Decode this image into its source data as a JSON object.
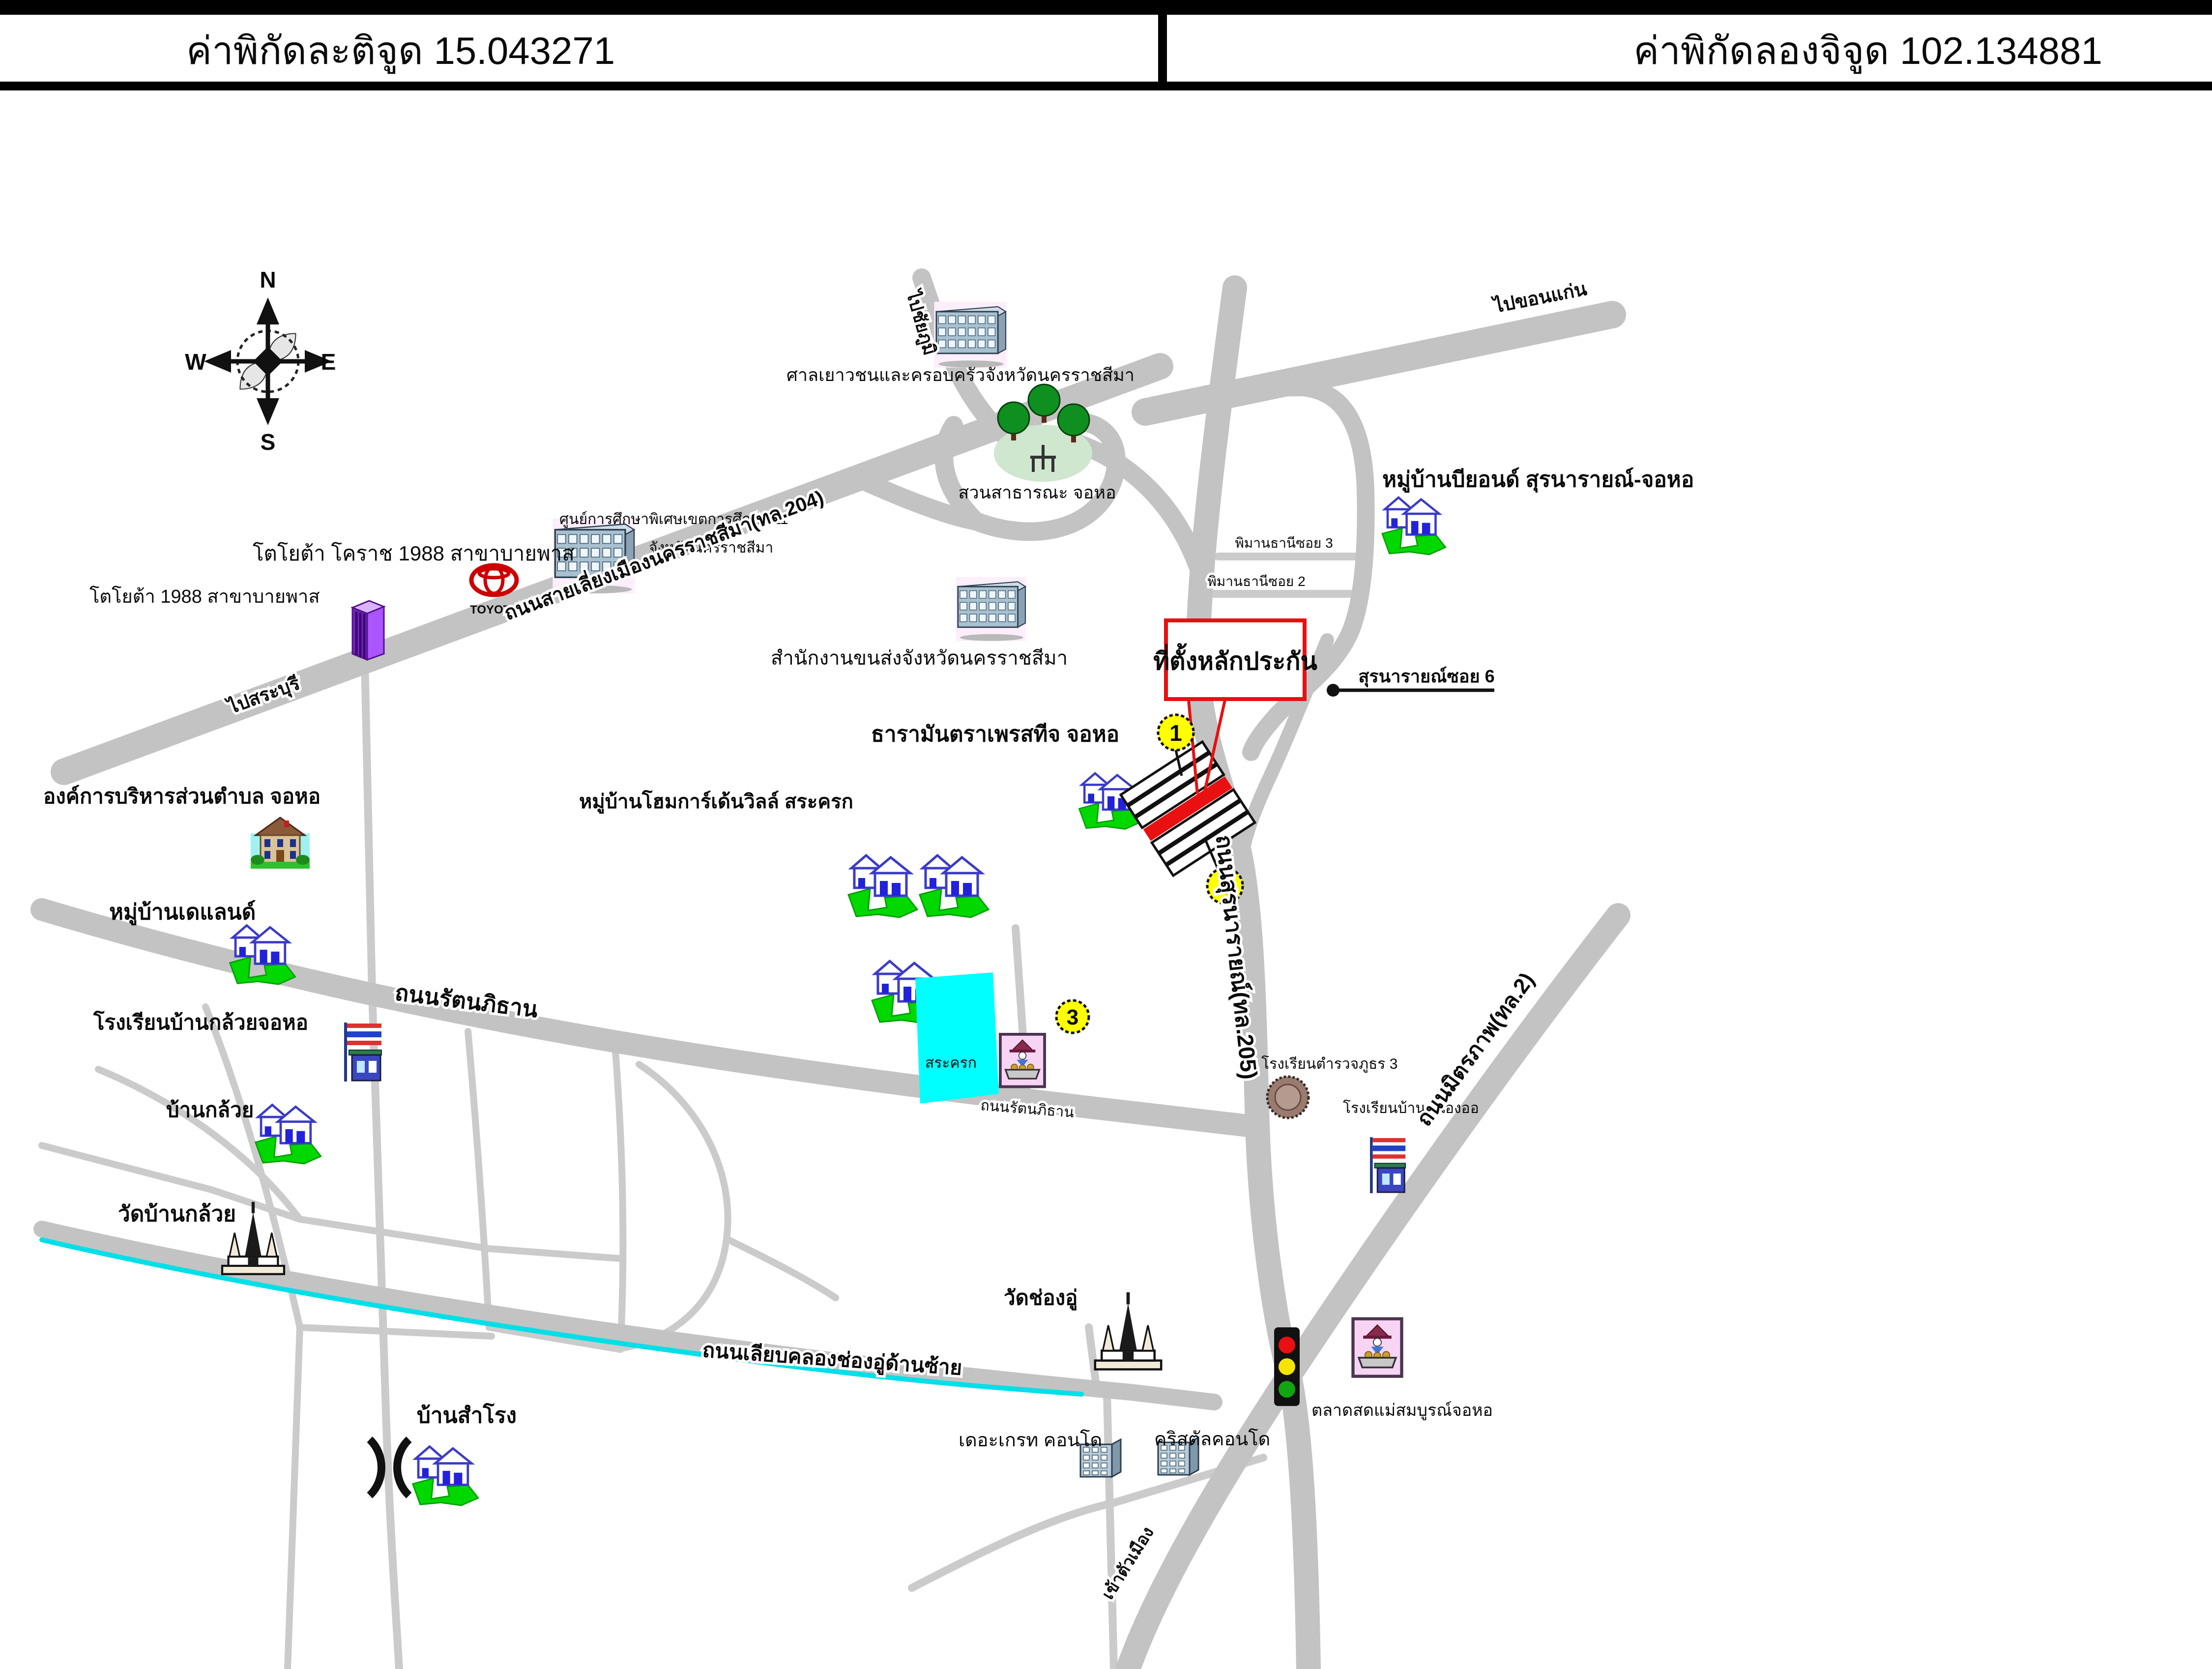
{
  "header": {
    "latitude": "ค่าพิกัดละติจูด 15.043271",
    "longitude": "ค่าพิกัดลองจิจูด 102.134881"
  },
  "compass": {
    "north": "N",
    "south": "S",
    "east": "E",
    "west": "W"
  },
  "markers": {
    "m1": "1",
    "m2": "2",
    "m3": "3"
  },
  "labels": {
    "to_khonkaen": "ไปขอนแก่น",
    "to_chaiyaphum": "ไปชัยภูมิ",
    "to_saraburi": "ไปสระบุรี",
    "juvenile_court": "ศาลเยาวชนและครอบครัวจังหวัดนครราชสีมา",
    "special_edu_center": "ศูนย์การศึกษาพิเศษเขตการศึกษา 11",
    "special_edu_province": "จังหวัดนครราชสีมา",
    "toyota_main": "โตโยต้า โคราช 1988 สาขาบายพาส",
    "toyota_second": "โตโยต้า 1988 สาขาบายพาส",
    "toyota_logo": "TOYOTA",
    "bypass_road": "ถนนสายเลี่ยงเมืองนครราชสีมา(ทล.204)",
    "park": "สวนสาธารณะ จอหอ",
    "transport_office": "สำนักงานขนส่งจังหวัดนครราชสีมา",
    "beyond_village": "หมู่บ้านบียอนด์ สุรนารายณ์-จอหอ",
    "piman_soi3": "พิมานธานีซอย 3",
    "piman_soi2": "พิมานธานีซอย 2",
    "suranarai_soi6": "สุรนารายณ์ซอย 6",
    "collateral_site": "ที่ตั้งหลักประกัน",
    "tara_mantra": "ธารามันตราเพรสทีจ จอหอ",
    "home_garden_ville": "หมู่บ้านโฮมการ์เด้นวิลล์ สระครก",
    "sao_chorho": "องค์การบริหารส่วนตำบล จอหอ",
    "de_land_village": "หมู่บ้านเดแลนด์",
    "rattanaphithan_main": "ถนนรัตนภิธาน",
    "rattanaphithan_small": "ถนนรัตนภิธาน",
    "ban_kluay_school": "โรงเรียนบ้านกล้วยจอหอ",
    "ban_kluay": "บ้านกล้วย",
    "wat_ban_kluay": "วัดบ้านกล้วย",
    "pond": "สระครก",
    "police_school": "โรงเรียนตำรวจภูธร 3",
    "nong_school": "โรงเรียนบ้านหนองออ",
    "suranarai_road": "ถนนสุรนารายณ์(ทล.205)",
    "mittraphap_road": "ถนนมิตรภาพ(ทล.2)",
    "wat_chong_u": "วัดช่องอู่",
    "canal_road": "ถนนเลียบคลองช่องอู่ด้านซ้าย",
    "market": "ตลาดสดแม่สมบูรณ์จอหอ",
    "great_condo": "เดอะเกรท คอนโด",
    "crystal_condo": "คริสตัลคอนโด",
    "ban_samrong": "บ้านสำโรง",
    "to_city": "เข้าตัวเมือง"
  },
  "colors": {
    "road": "#c3c3c3",
    "thin_road": "#cbcbcb",
    "canal": "#00dfe8",
    "pond": "#00ffff",
    "highlight": "#e81010",
    "marker_fill": "#ffff00",
    "lawn": "#00d800"
  }
}
